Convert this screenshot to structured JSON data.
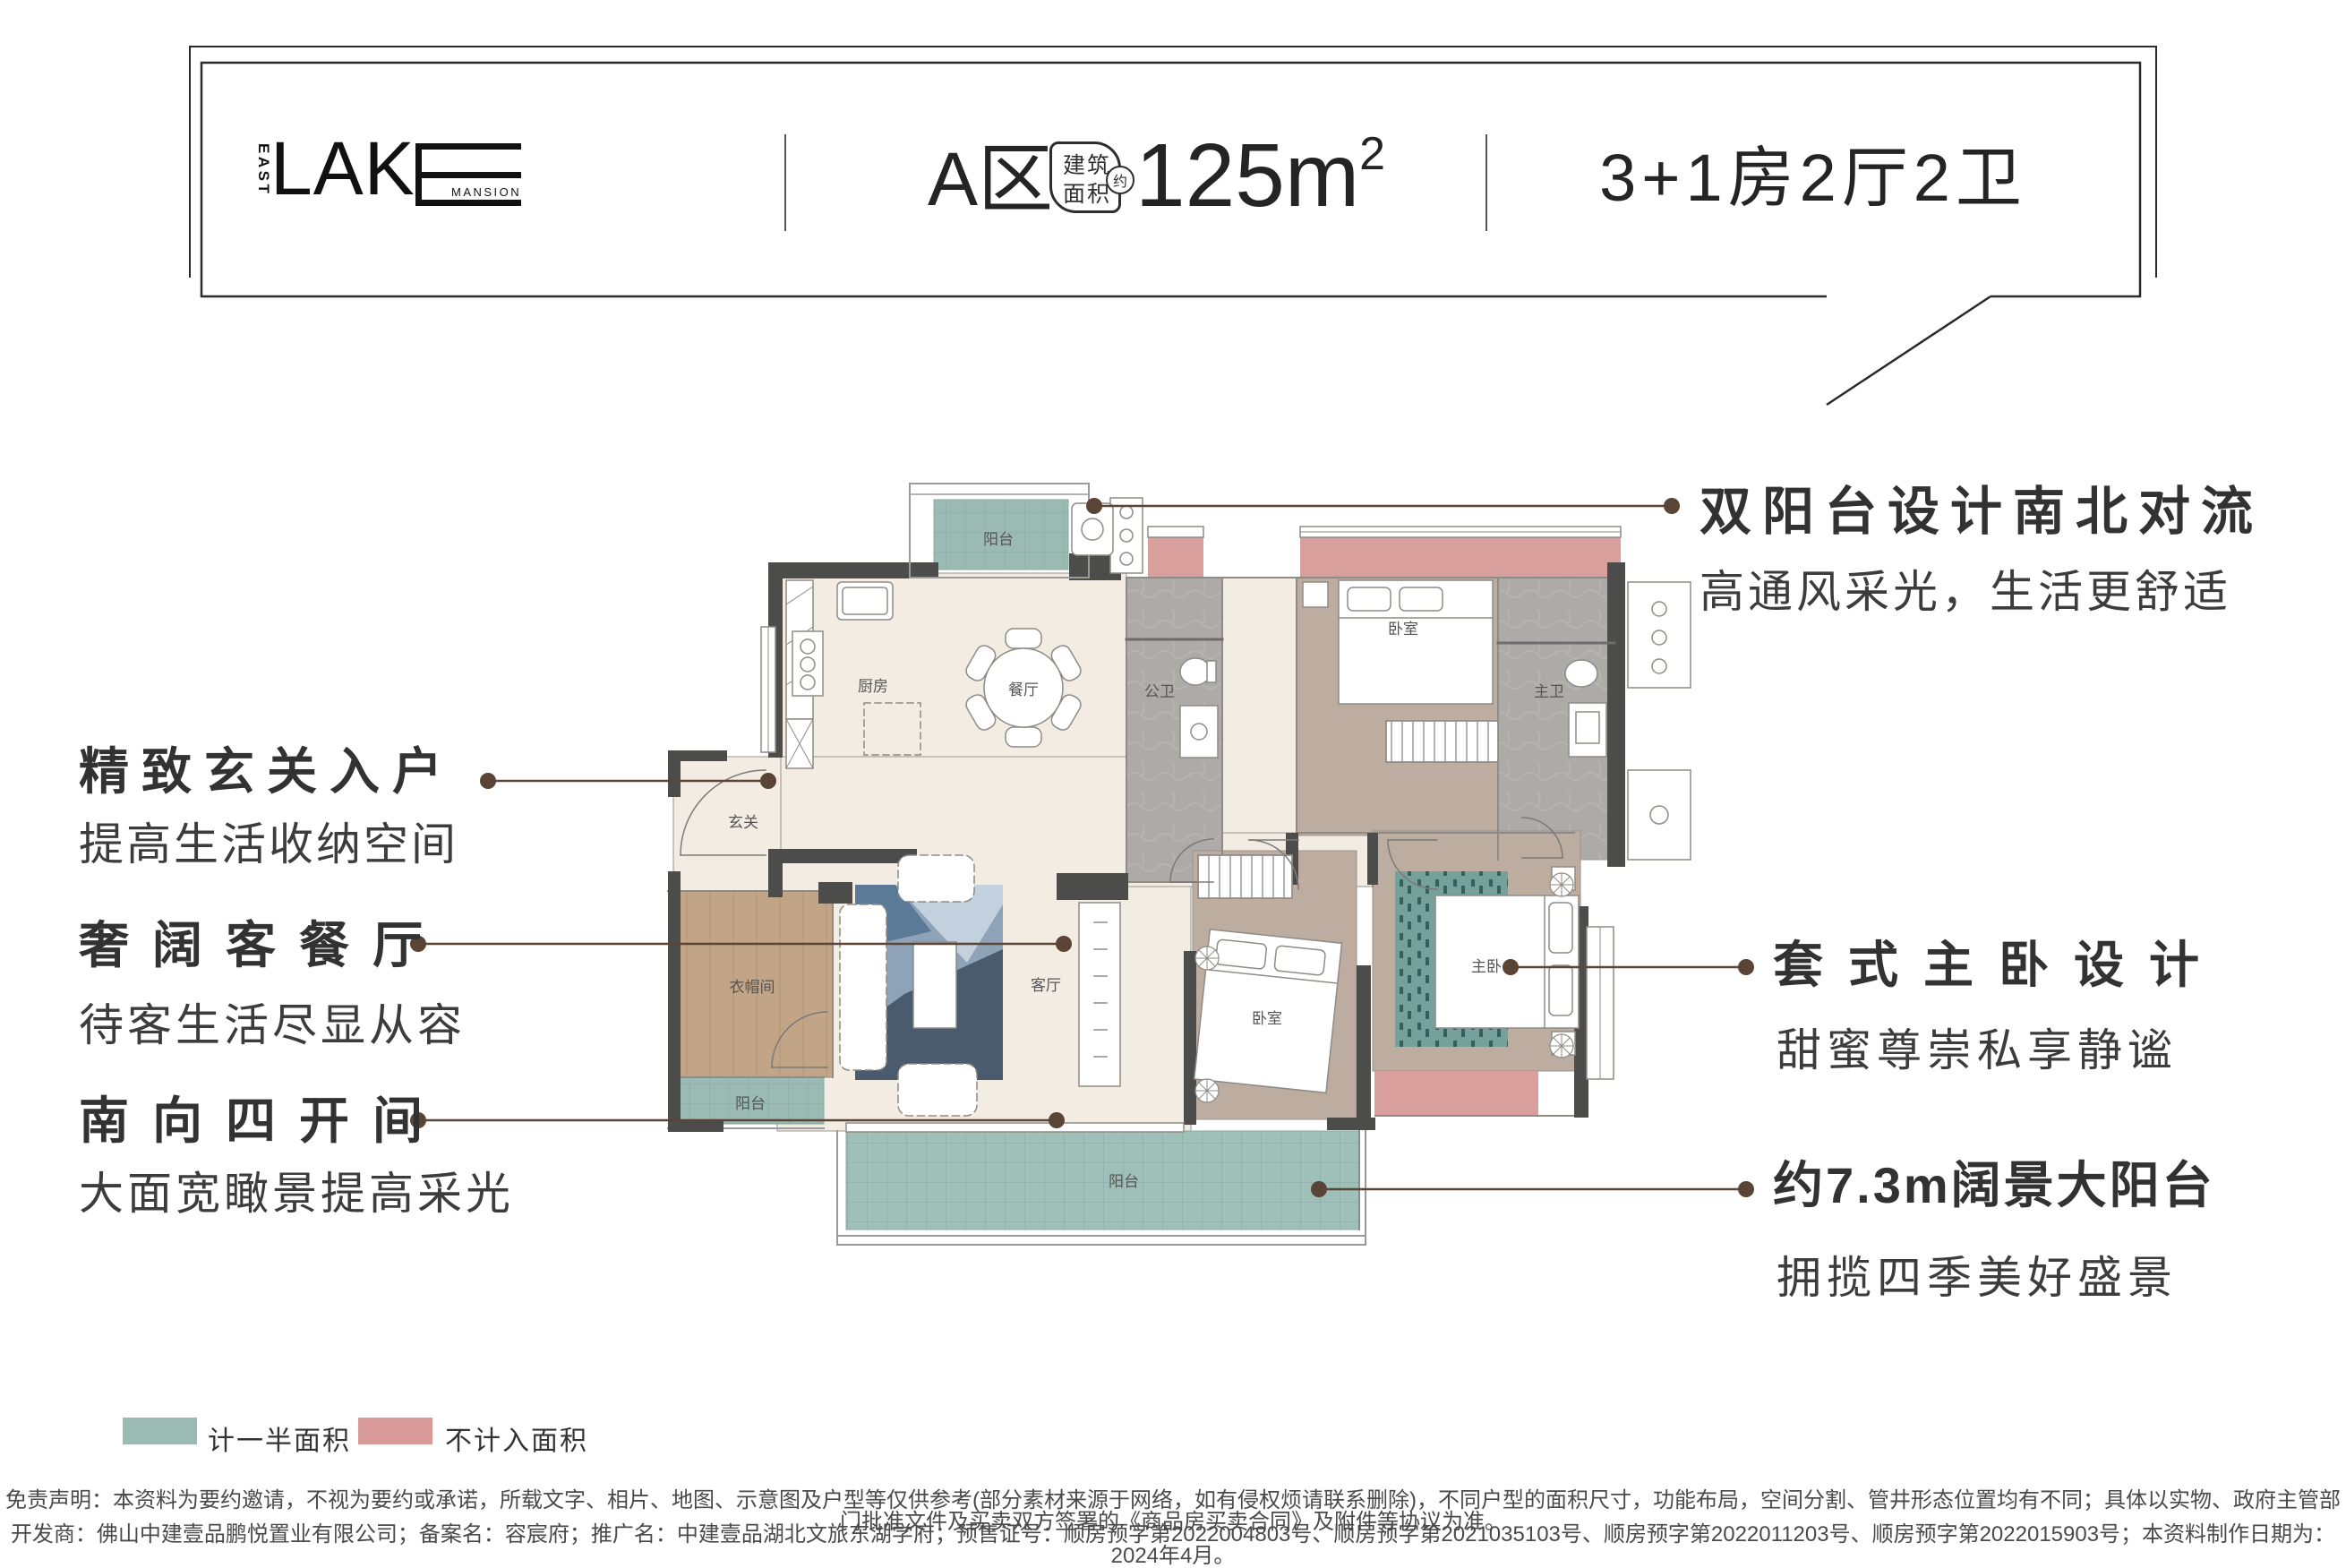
{
  "header": {
    "logo_east": "EAST",
    "logo_lake": "LAK",
    "logo_mansion": "MANSION",
    "zone": "A区",
    "badge_line1": "建筑",
    "badge_line2": "面积",
    "badge_approx": "约",
    "area_value": "125m",
    "area_sup": "2",
    "layout": "3+1房2厅2卫"
  },
  "annotations": {
    "left": [
      {
        "title": "精致玄关入户",
        "subtitle": "提高生活收纳空间"
      },
      {
        "title": "奢阔客餐厅",
        "subtitle": "待客生活尽显从容"
      },
      {
        "title": "南向四开间",
        "subtitle": "大面宽瞰景提高采光"
      }
    ],
    "right": [
      {
        "title": "双阳台设计南北对流",
        "subtitle": "高通风采光，生活更舒适"
      },
      {
        "title": "套式主卧设计",
        "subtitle": "甜蜜尊崇私享静谧"
      },
      {
        "title": "约7.3m阔景大阳台",
        "subtitle": "拥揽四季美好盛景"
      }
    ]
  },
  "floorplan": {
    "balcony_north": "阳台",
    "kitchen": "厨房",
    "dining": "餐厅",
    "public_bath": "公卫",
    "bedroom_ne": "卧室",
    "master_bath": "主卫",
    "foyer": "玄关",
    "cloakroom": "衣帽间",
    "balcony_west": "阳台",
    "living": "客厅",
    "bedroom_south": "卧室",
    "master_bedroom": "主卧",
    "balcony_south": "阳台"
  },
  "legend": {
    "half_area": "计一半面积",
    "excluded_area": "不计入面积"
  },
  "colors": {
    "teal": "#9cbab4",
    "pink": "#d99f9d",
    "wall": "#4c4c4a",
    "leader": "#5a4435"
  },
  "disclaimer_line1": "免责声明：本资料为要约邀请，不视为要约或承诺，所载文字、相片、地图、示意图及户型等仅供参考(部分素材来源于网络，如有侵权烦请联系删除)，不同户型的面积尺寸，功能布局，空间分割、管井形态位置均有不同；具体以实物、政府主管部门批准文件及买卖双方签署的《商品房买卖合同》及附件等协议为准。",
  "disclaimer_line2": "开发商：佛山中建壹品鹏悦置业有限公司；备案名：容宸府；推广名：中建壹品湖北文旅东湖学府；预售证号：顺房预字第2022004803号、顺房预字第2021035103号、顺房预字第2022011203号、顺房预字第2022015903号；本资料制作日期为：2024年4月。"
}
